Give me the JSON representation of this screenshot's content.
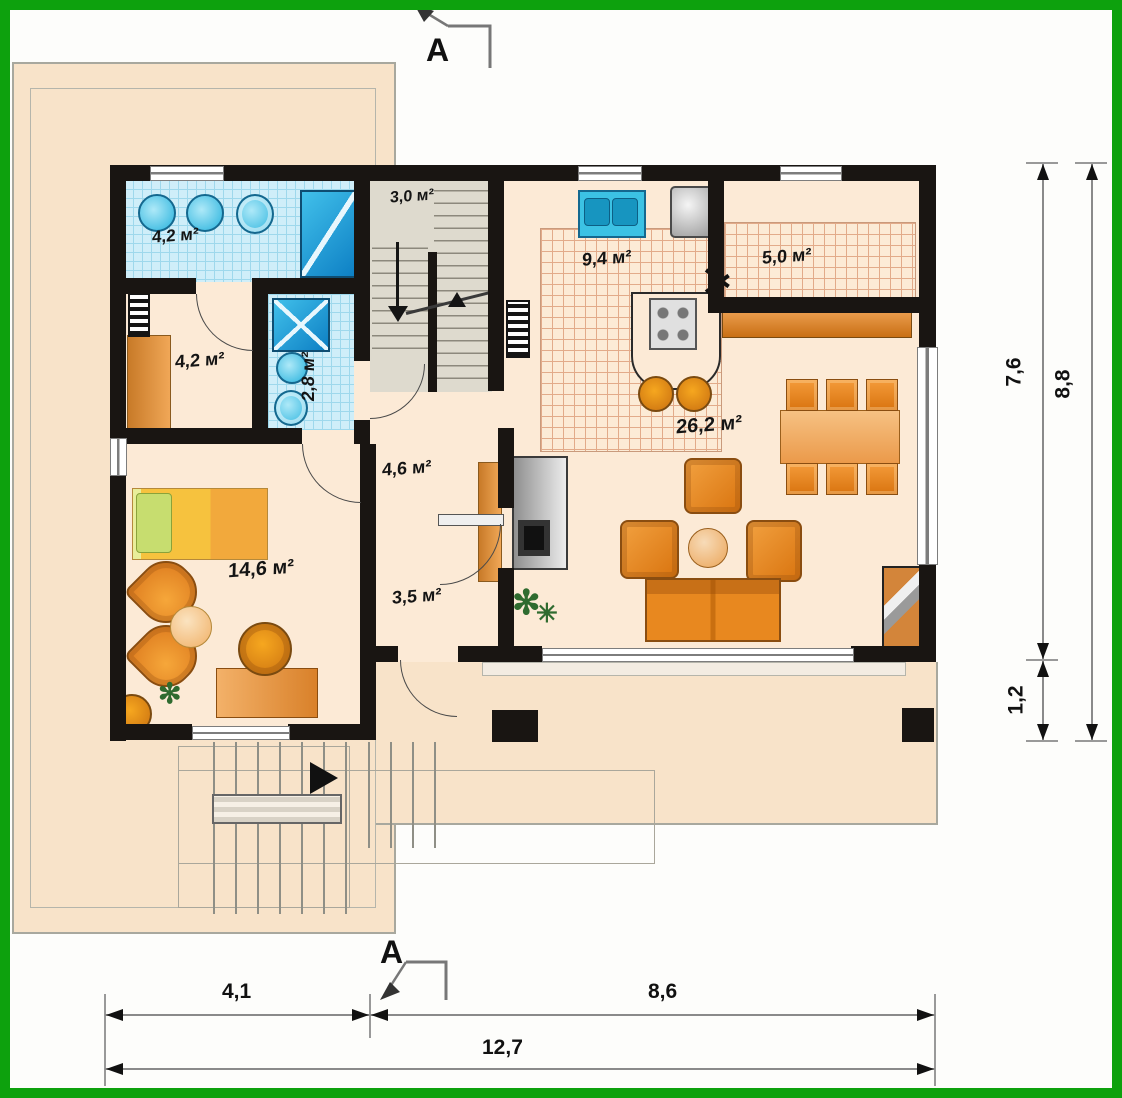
{
  "section_marks": {
    "top": "A",
    "bottom": "A"
  },
  "rooms": {
    "bathroom": "4,2 м²",
    "dressing": "4,2 м²",
    "wc": "2,8 м²",
    "staircase": "3,0 м²",
    "kitchen": "9,4 м²",
    "pantry": "5,0 м²",
    "hall": "4,6 м²",
    "corridor": "3,5 м²",
    "living_room": "26,2 м²",
    "bedroom": "14,6 м²"
  },
  "dimensions": {
    "right_height_main": "7,6",
    "right_height_terrace": "1,2",
    "right_height_total": "8,8",
    "bottom_width_left": "4,1",
    "bottom_width_right": "8,6",
    "bottom_width_total": "12,7"
  },
  "icons": {
    "plant_glyph": "✻",
    "plant_glyph_small": "✳"
  },
  "colors": {
    "frame_green": "#0da10d",
    "wall_black": "#191512",
    "floor_cream": "#fcead6",
    "terrace_cream": "#f8e3c9",
    "tile_blue": "#cfeef9",
    "fixture_blue": "#27b2dd",
    "furniture_orange": "#e8821e",
    "bed_yellow": "#f6c23e"
  }
}
